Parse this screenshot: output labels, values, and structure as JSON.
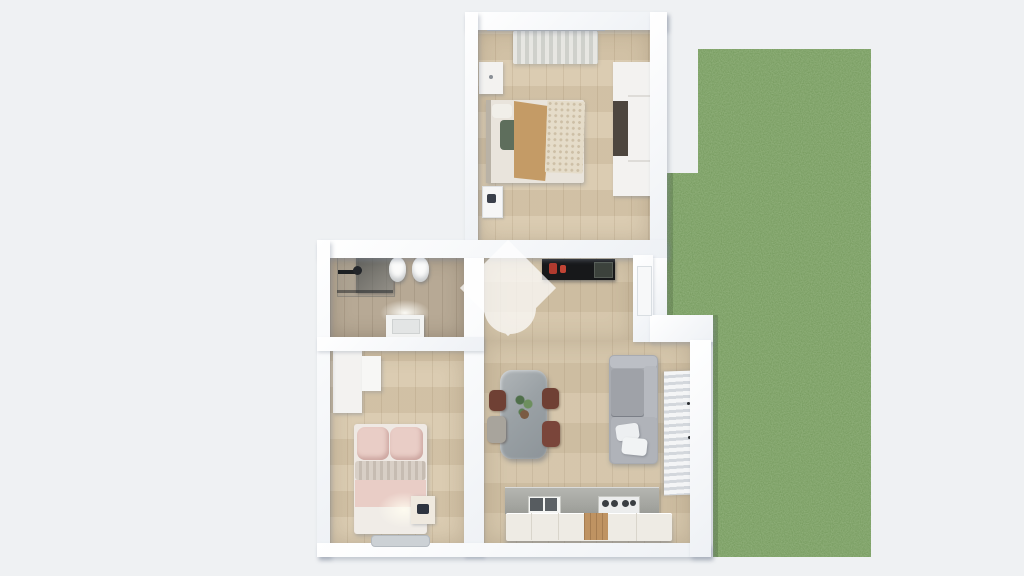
{
  "title": "3D top-view apartment floor plan with garden",
  "scene": {
    "view": "orthographic-top-down-3d-render",
    "background_color": "#eff1f3",
    "wall_color": "#ffffff",
    "wood_floor_color": "#d5c4a8",
    "bathroom_floor_color": "#b7a995",
    "grass_color": "#6f9456"
  },
  "rooms": [
    {
      "id": "bedroom-main",
      "position": "top-center",
      "furniture": [
        "window-curtain",
        "curtain-rod",
        "nightstand",
        "double-bed-with-tan-blanket",
        "wardrobe-with-open-dark-section",
        "wall-panel"
      ]
    },
    {
      "id": "bathroom",
      "position": "middle-left",
      "furniture": [
        "shower-with-glass-panel",
        "shower-arm",
        "wall-hung-toilet",
        "wall-hung-bidet",
        "vanity-sink-with-light"
      ]
    },
    {
      "id": "bedroom-second",
      "position": "bottom-left",
      "furniture": [
        "wardrobe",
        "wall-shelf",
        "bed-with-pink-bedding",
        "nightstand-with-lamp-glow",
        "door-threshold"
      ]
    },
    {
      "id": "living-kitchen",
      "position": "center-right",
      "furniture": [
        "tv-console-black-with-red-decor",
        "garden-door-recess",
        "gray-sectional-sofa-with-white-pillows",
        "marble-dining-table-with-plant",
        "dining-chair",
        "dining-chair",
        "dining-chair",
        "dining-chair",
        "kitchen-counter-concrete",
        "double-sink",
        "cooktop",
        "kitchen-base-cabinets-with-wood-insert",
        "window-blinds-slatted"
      ]
    },
    {
      "id": "garden",
      "position": "right",
      "surface": "grass-lawn",
      "shape": "L-notched-rectangle"
    }
  ],
  "watermark": {
    "shape": "diamond-with-circle-pin",
    "color": "#ffffff",
    "opacity": 0.72,
    "center": "over-living-room-left"
  },
  "colors": {
    "sofa": "#a8abb1",
    "dining_table": "#a2a8ac",
    "chair_brown": "#6f4034",
    "chair_gray": "#a8a49c",
    "kitchen_counter": "#abaca7",
    "kitchen_cabinet": "#eeebe4",
    "kitchen_wood_insert": "#bf9362",
    "tv_console": "#17181a",
    "tv_decor_red": "#b03a2e",
    "bed1_blanket_tan": "#c49b66",
    "bed1_throw_cream": "#e5dcc9",
    "bed1_pillow_sage": "#5e6e5c",
    "bed2_pink": "#e9cdc6",
    "bed2_knit": "#d4cac1",
    "shower_glass": "#3c4144"
  }
}
